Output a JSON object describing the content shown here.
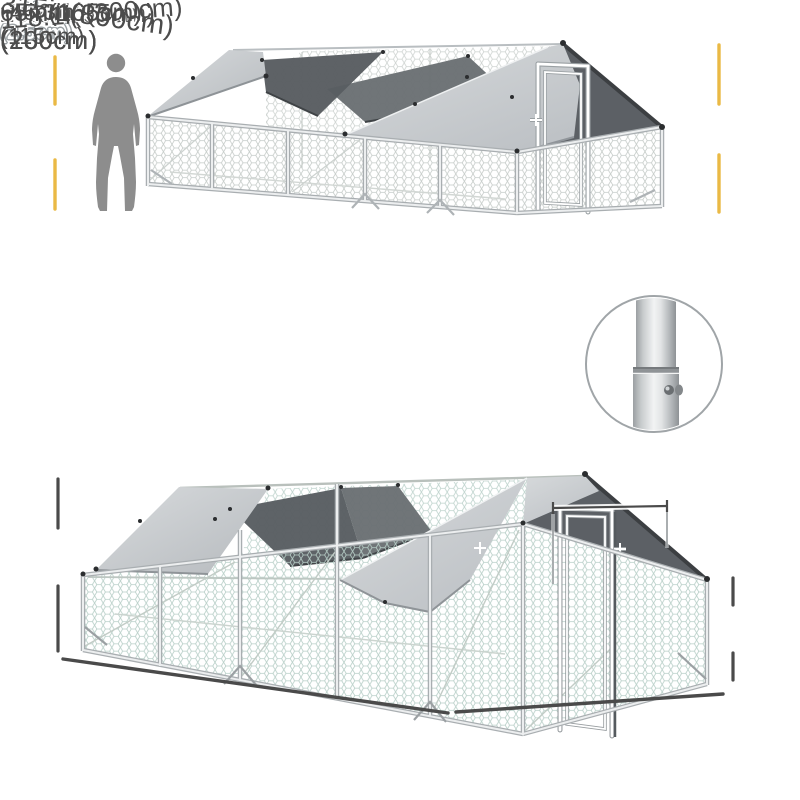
{
  "page": {
    "background": "#ffffff"
  },
  "palette": {
    "accent_yellow": "#EAB945",
    "dimension_line": "#4A4A4A",
    "label_text": "#4C4C4C",
    "cover_gray_light": "#D7DADC",
    "cover_gray_dark": "#B9BDC1",
    "shade_net_gray": "#5C6065",
    "mesh_stroke_top": "#C4CAC7",
    "mesh_stroke_bottom": "#B7CEC7",
    "frame_silver": "#ECEEEF",
    "silhouette_gray": "#8D8D8D"
  },
  "top_view": {
    "person_height": {
      "line1": "70.9in",
      "line2": "(180cm)"
    },
    "total_height": {
      "line1": "78.7in",
      "line2": "(200cm)"
    }
  },
  "joint_detail": {
    "tube_diameter": {
      "line1": "1in",
      "line2": "(2.5cm)"
    }
  },
  "bottom_view": {
    "ridge_height": {
      "line1": "78.7in",
      "line2": "(200cm)"
    },
    "door_width": "25.6in(65cm)",
    "door_height": "65in(165cm)",
    "side_wall_height": {
      "line1": "45.3in",
      "line2": "(115cm)"
    },
    "run_length": "315in(800cm)",
    "run_width": "118.1in(300cm)"
  }
}
